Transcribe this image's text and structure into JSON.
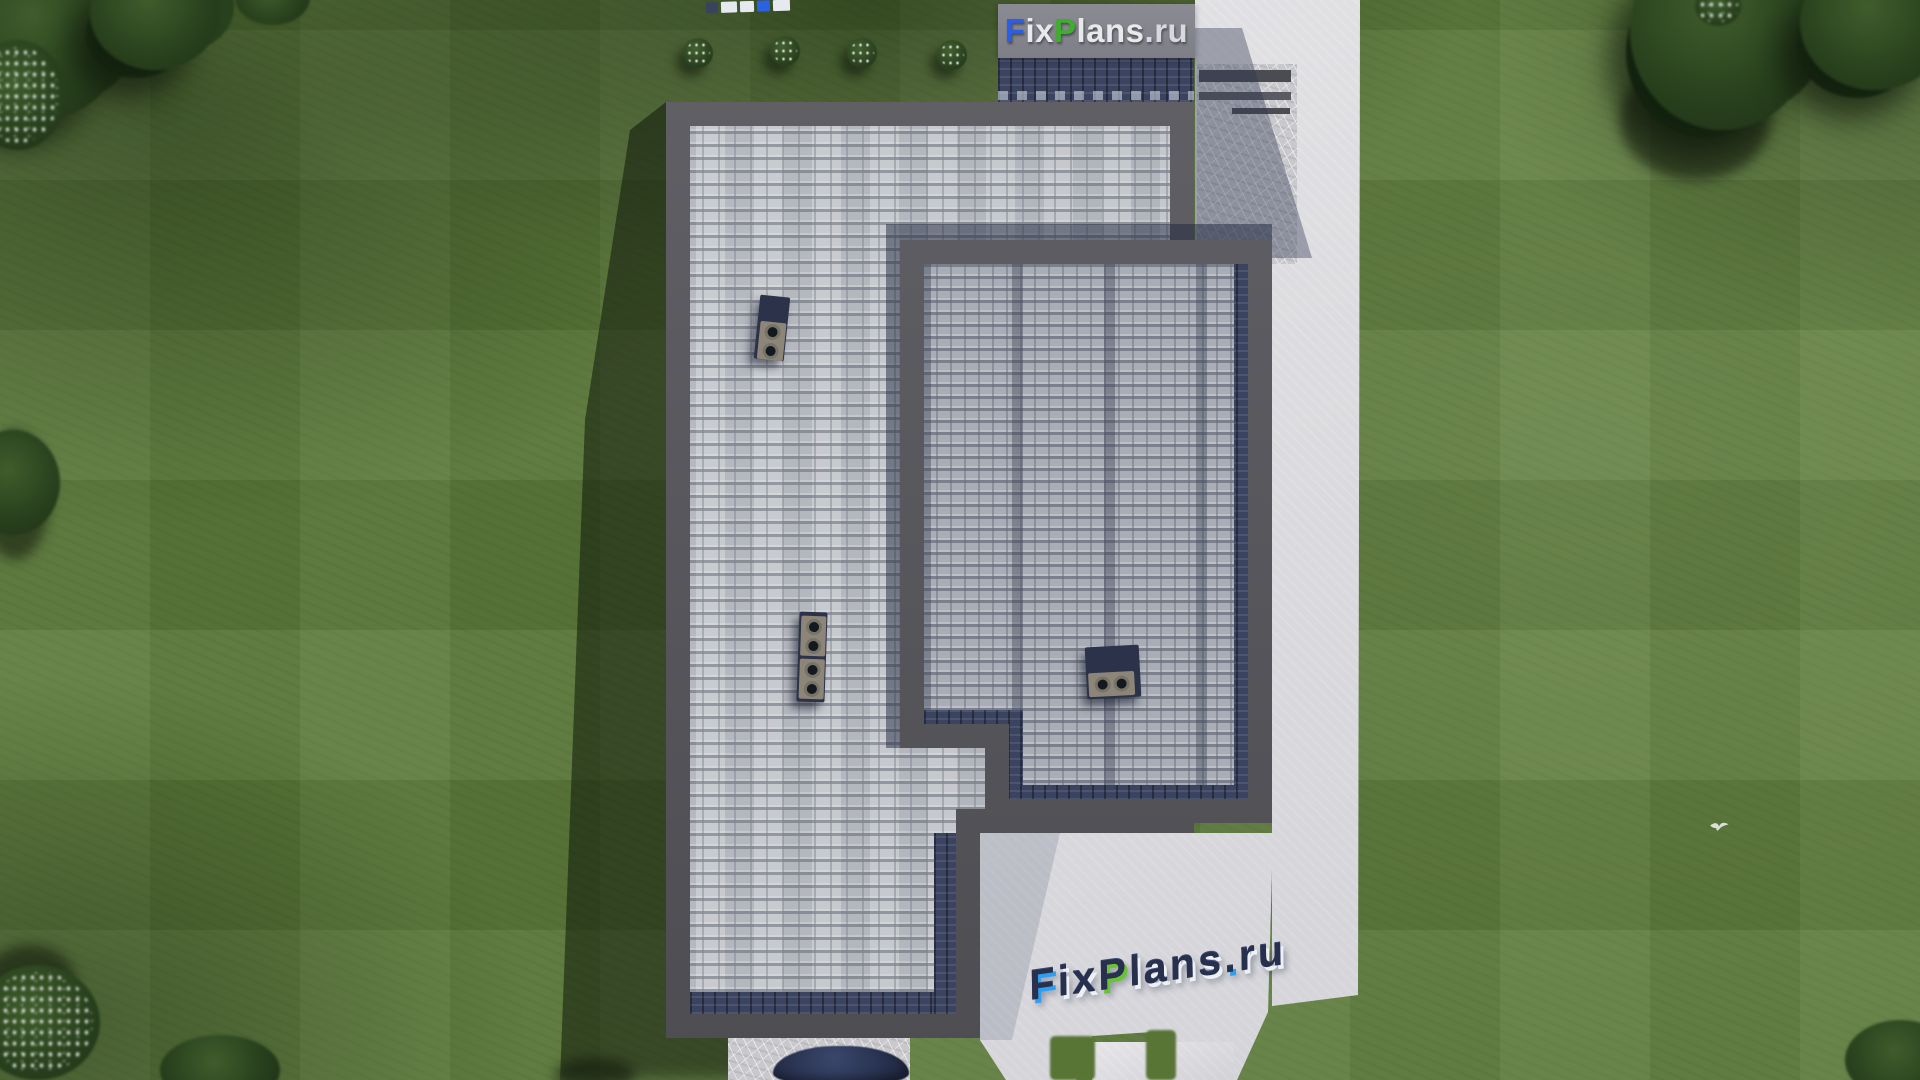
{
  "meta": {
    "width": 1920,
    "height": 1080,
    "description": "Aerial top-down 3D architectural render of a house roof plan with gray shingle roofs on a green lawn, concrete paths, trees and FixPlans.ru watermarks"
  },
  "branding": {
    "watermark_top": {
      "full_text": "FixPlans.ru",
      "parts": [
        {
          "text": "F",
          "color": "#2b5fe3"
        },
        {
          "text": "ix",
          "color": "#e9e9ec"
        },
        {
          "text": "P",
          "color": "#3fae2c"
        },
        {
          "text": "lans",
          "color": "#e9e9ec"
        },
        {
          "text": ".ru",
          "color": "#d8d9df"
        }
      ]
    },
    "watermark_bottom_3d": {
      "full_text": "FixPlans.ru",
      "style": "extruded 3D letters lying on concrete pad, navy tops with white, blue and green faces",
      "parts": [
        {
          "text": "F",
          "face": "#2e9ff0"
        },
        {
          "text": "ix",
          "face": "#edf0f5"
        },
        {
          "text": "P",
          "face": "#68c52f"
        },
        {
          "text": "lans",
          "face": "#edf0f5"
        },
        {
          "text": ".",
          "face": "#2e9ff0"
        },
        {
          "text": "ru",
          "face": "#edf0f5"
        }
      ]
    },
    "watermark_top_edge": {
      "full_text": "FixPlans.ru",
      "note": "tiny logo clipped at the very top edge of the frame"
    }
  },
  "palette": {
    "grass": "#5e7c3c",
    "grass_shadow": "#24371a",
    "tree_foliage": "#2a421e",
    "roof_shingles_light": "#c4c7cc",
    "roof_shingles_upper": "#a9adb6",
    "roof_eave_navy": "#3a4360",
    "roof_border_gray": "#57575d",
    "pavement_concrete": "#d8d8dc",
    "logo_blue": "#2b5fe3",
    "logo_green": "#3fae2c",
    "logo_navy": "#27304d"
  },
  "scene": {
    "type": "aerial 3D render, roof plan view",
    "house": {
      "roof_sections": 2,
      "lower_roof": "light gray square shingles, L-shaped, dark gray parapet border, navy eave band at bottom edge",
      "upper_roof": "gray shingles with vertical ridge striping, dark border, navy eave bands on right and bottom",
      "chimneys": [
        {
          "id": "upper-left",
          "vents": 2,
          "orientation": "vertical"
        },
        {
          "id": "lower-left",
          "vents": 4,
          "orientation": "vertical"
        },
        {
          "id": "right-roof",
          "vents": 2,
          "orientation": "horizontal"
        }
      ]
    },
    "landscape": {
      "flowering_bushes_top_row": 4,
      "tree_clusters": 9,
      "flying_bird": 1,
      "concrete_areas": [
        "right side walkway",
        "top-right patio with steps",
        "bottom pad with 3D logo",
        "bottom driveway"
      ]
    }
  }
}
